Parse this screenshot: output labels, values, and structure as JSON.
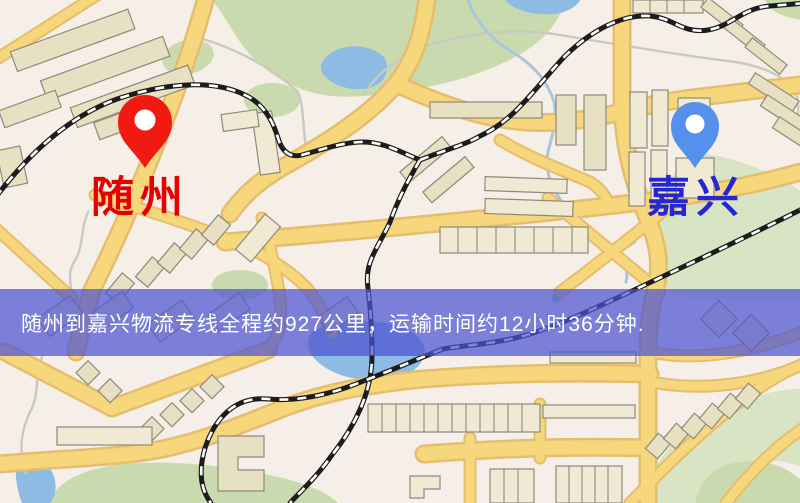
{
  "markers": {
    "origin": {
      "label": "随州",
      "label_color": "#e60000",
      "pin_color": "#f01a10"
    },
    "destination": {
      "label": "嘉兴",
      "label_color": "#2727d2",
      "pin_color": "#5590ec"
    }
  },
  "banner": {
    "text": "随州到嘉兴物流专线全程约927公里，运输时间约12小时36分钟.",
    "background_color": "rgba(76,83,209,0.72)",
    "text_color": "#ffffff",
    "route": {
      "origin": "随州",
      "destination": "嘉兴",
      "distance_km": "927",
      "duration": "12小时36分钟"
    }
  },
  "map_palette": {
    "background": "#f5efe7",
    "road_fill": "#f7d77c",
    "road_casing": "#e5bd6e",
    "park": "#c9daae",
    "water": "#8ebbe3",
    "railway": "#1c1c1c",
    "building": "#e8e0c2"
  }
}
